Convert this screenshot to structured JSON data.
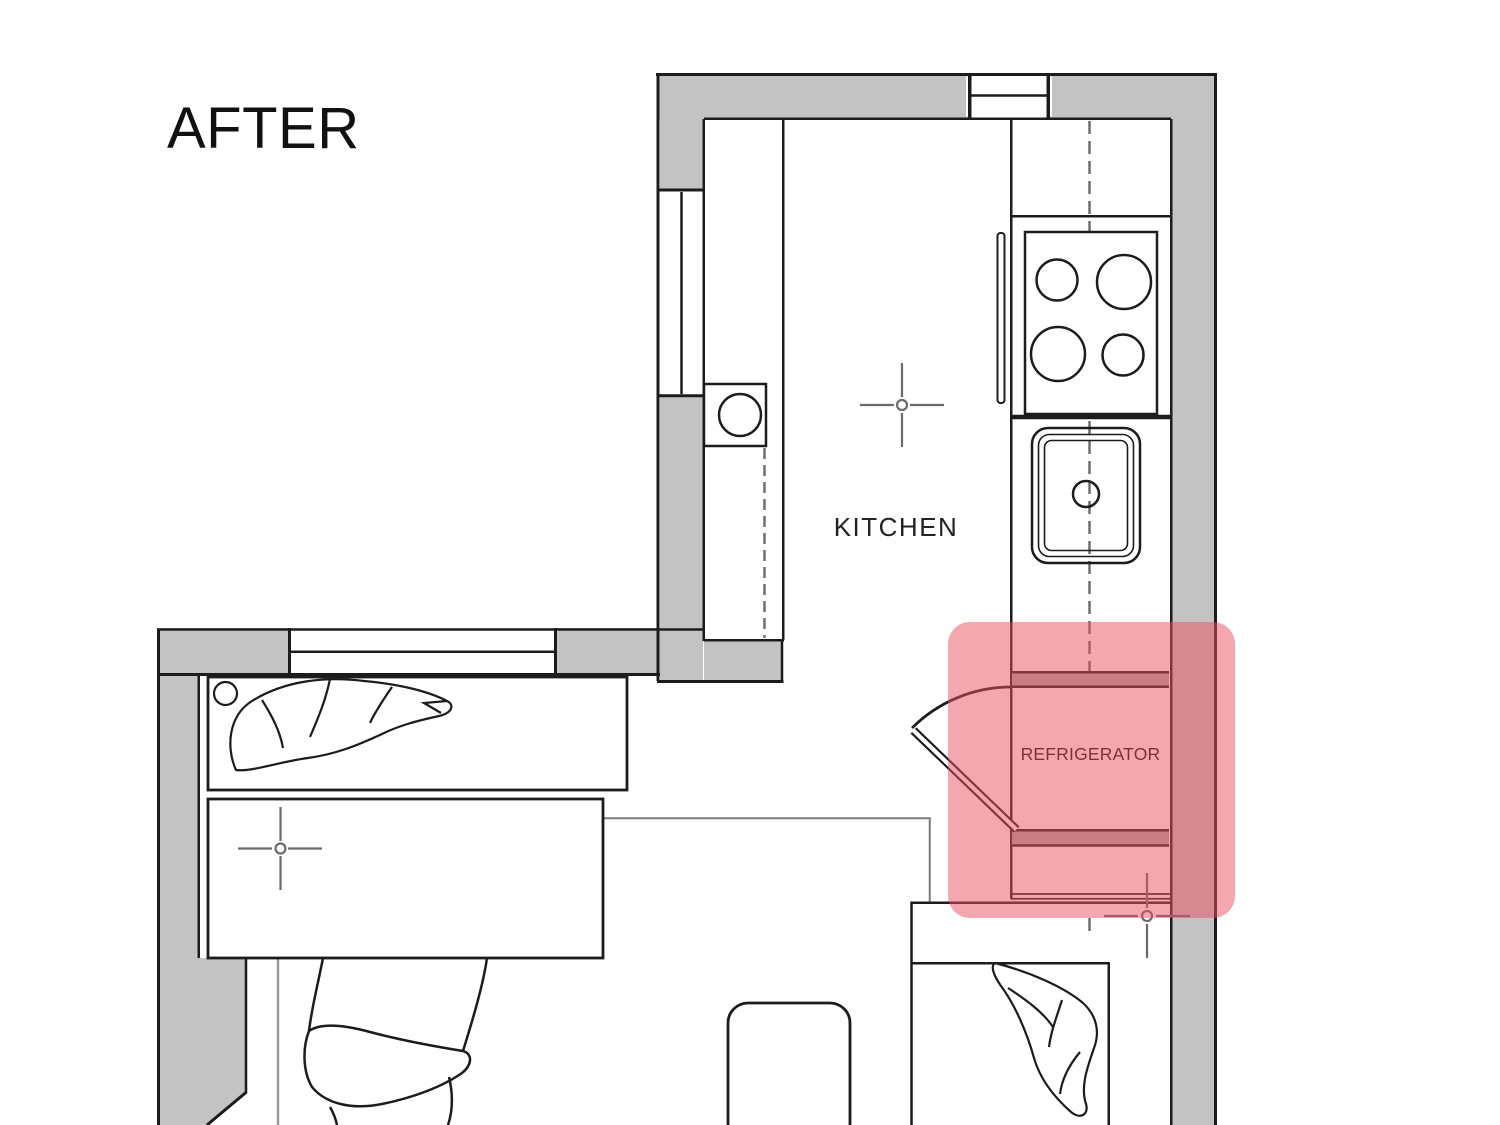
{
  "title": "AFTER",
  "plan": {
    "kitchen_label": "KITCHEN",
    "refrigerator_label": "REFRIGERATOR"
  },
  "highlight": {
    "purpose": "refrigerator-location",
    "opacity": 0.5
  },
  "colors": {
    "wall-fill": "#c3c3c3",
    "line": "#1c1c1c",
    "band-fill": "#ababab",
    "highlight": "#e9505f",
    "mark-gray": "#6a6a6a",
    "dash-gray": "#6e6e6e",
    "thin-gray": "#9a9a9a",
    "boundary-gray": "#7a7a7a"
  }
}
